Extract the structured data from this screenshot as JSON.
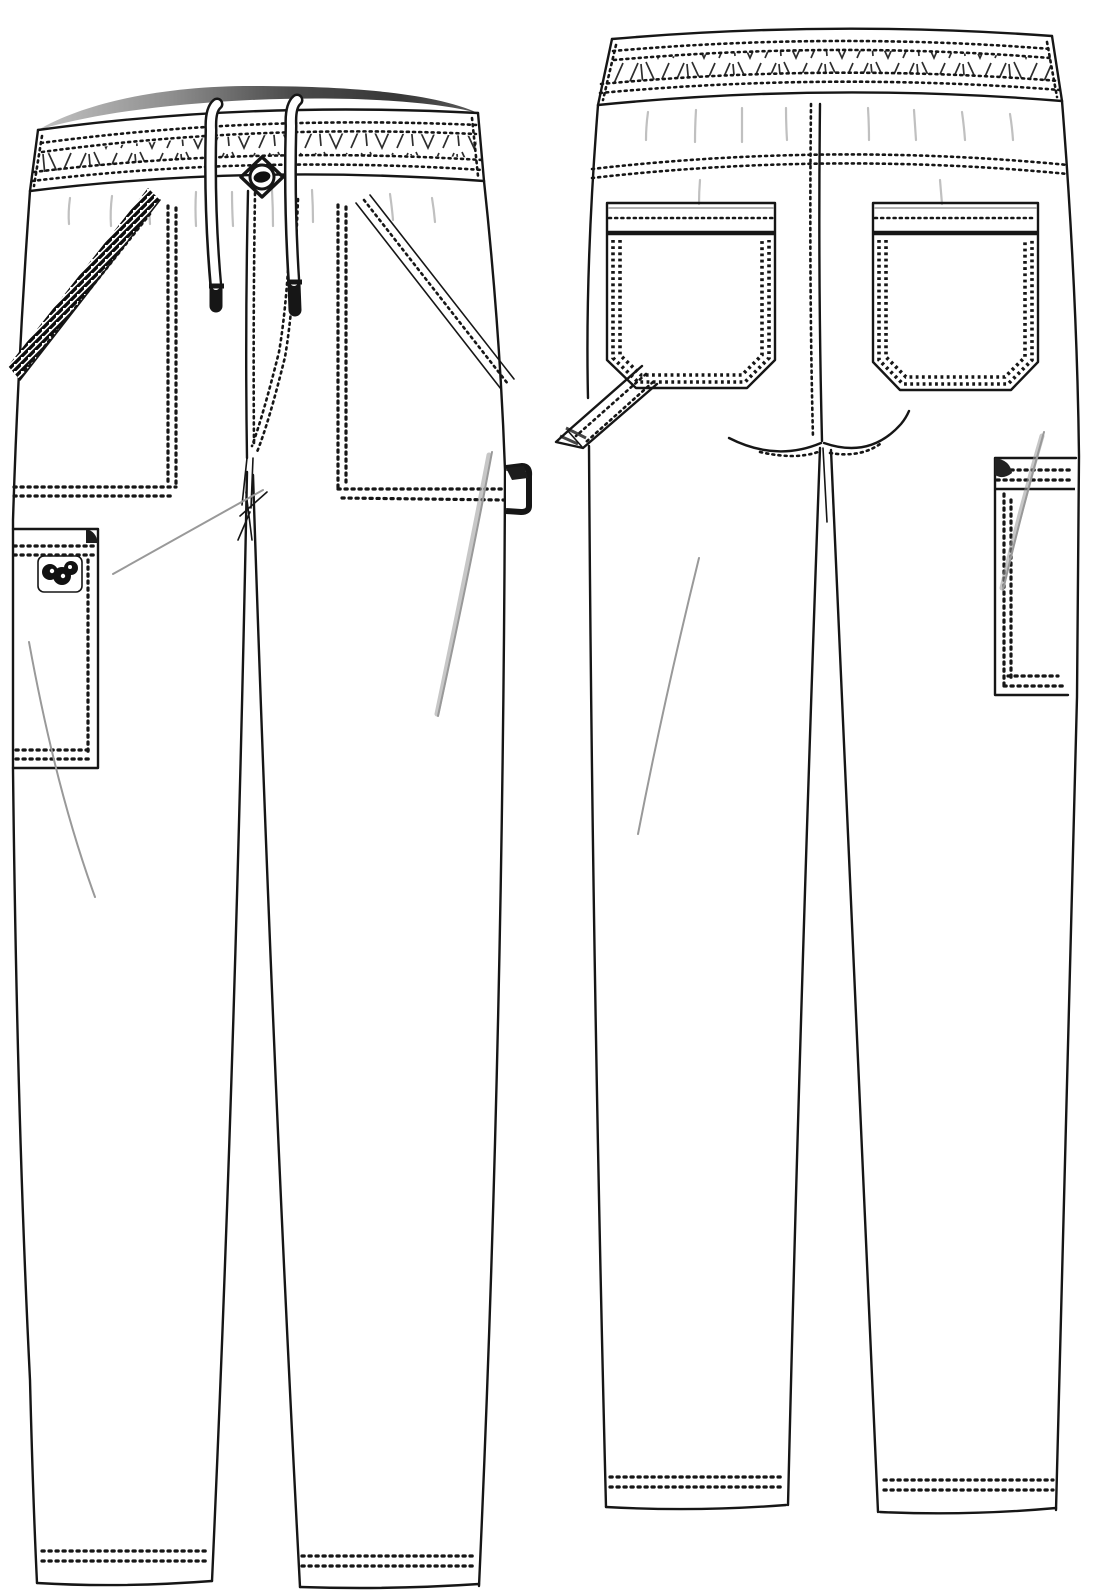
{
  "artwork": {
    "kind": "garment-technical-flat-sketch",
    "garment": "drawstring cargo pants",
    "views": [
      {
        "id": "front",
        "name": "front view"
      },
      {
        "id": "back",
        "name": "back view"
      }
    ],
    "features": [
      "elastic shirred waistband with double topstitch rows",
      "functional drawstring with two hanging cords and aglets",
      "center-front button",
      "fly J-topstitch",
      "slanted front pockets with contrast trim band (left) and stitched band (right)",
      "side cargo patch pocket with small brand logo patch",
      "side hammer loop tab at right seam",
      "back yoke topstitch seam",
      "two back patch pockets with angled bottom corners",
      "back hammer loop at left side seam",
      "back side cargo pocket",
      "double-needle hem topstitching"
    ]
  },
  "colors": {
    "background": "#ffffff",
    "ink": "#161616",
    "stitch": "#111111",
    "elastic_mark": "#2e2e2e",
    "crease": "#999999",
    "gather": "#b5b5b5",
    "waist_shade_light": "#c2c2c2",
    "waist_shade_mid": "#8f8f8f",
    "waist_shade_dark": "#373737",
    "trim_dark": "#0d0d0d",
    "fabric": "#ffffff"
  }
}
